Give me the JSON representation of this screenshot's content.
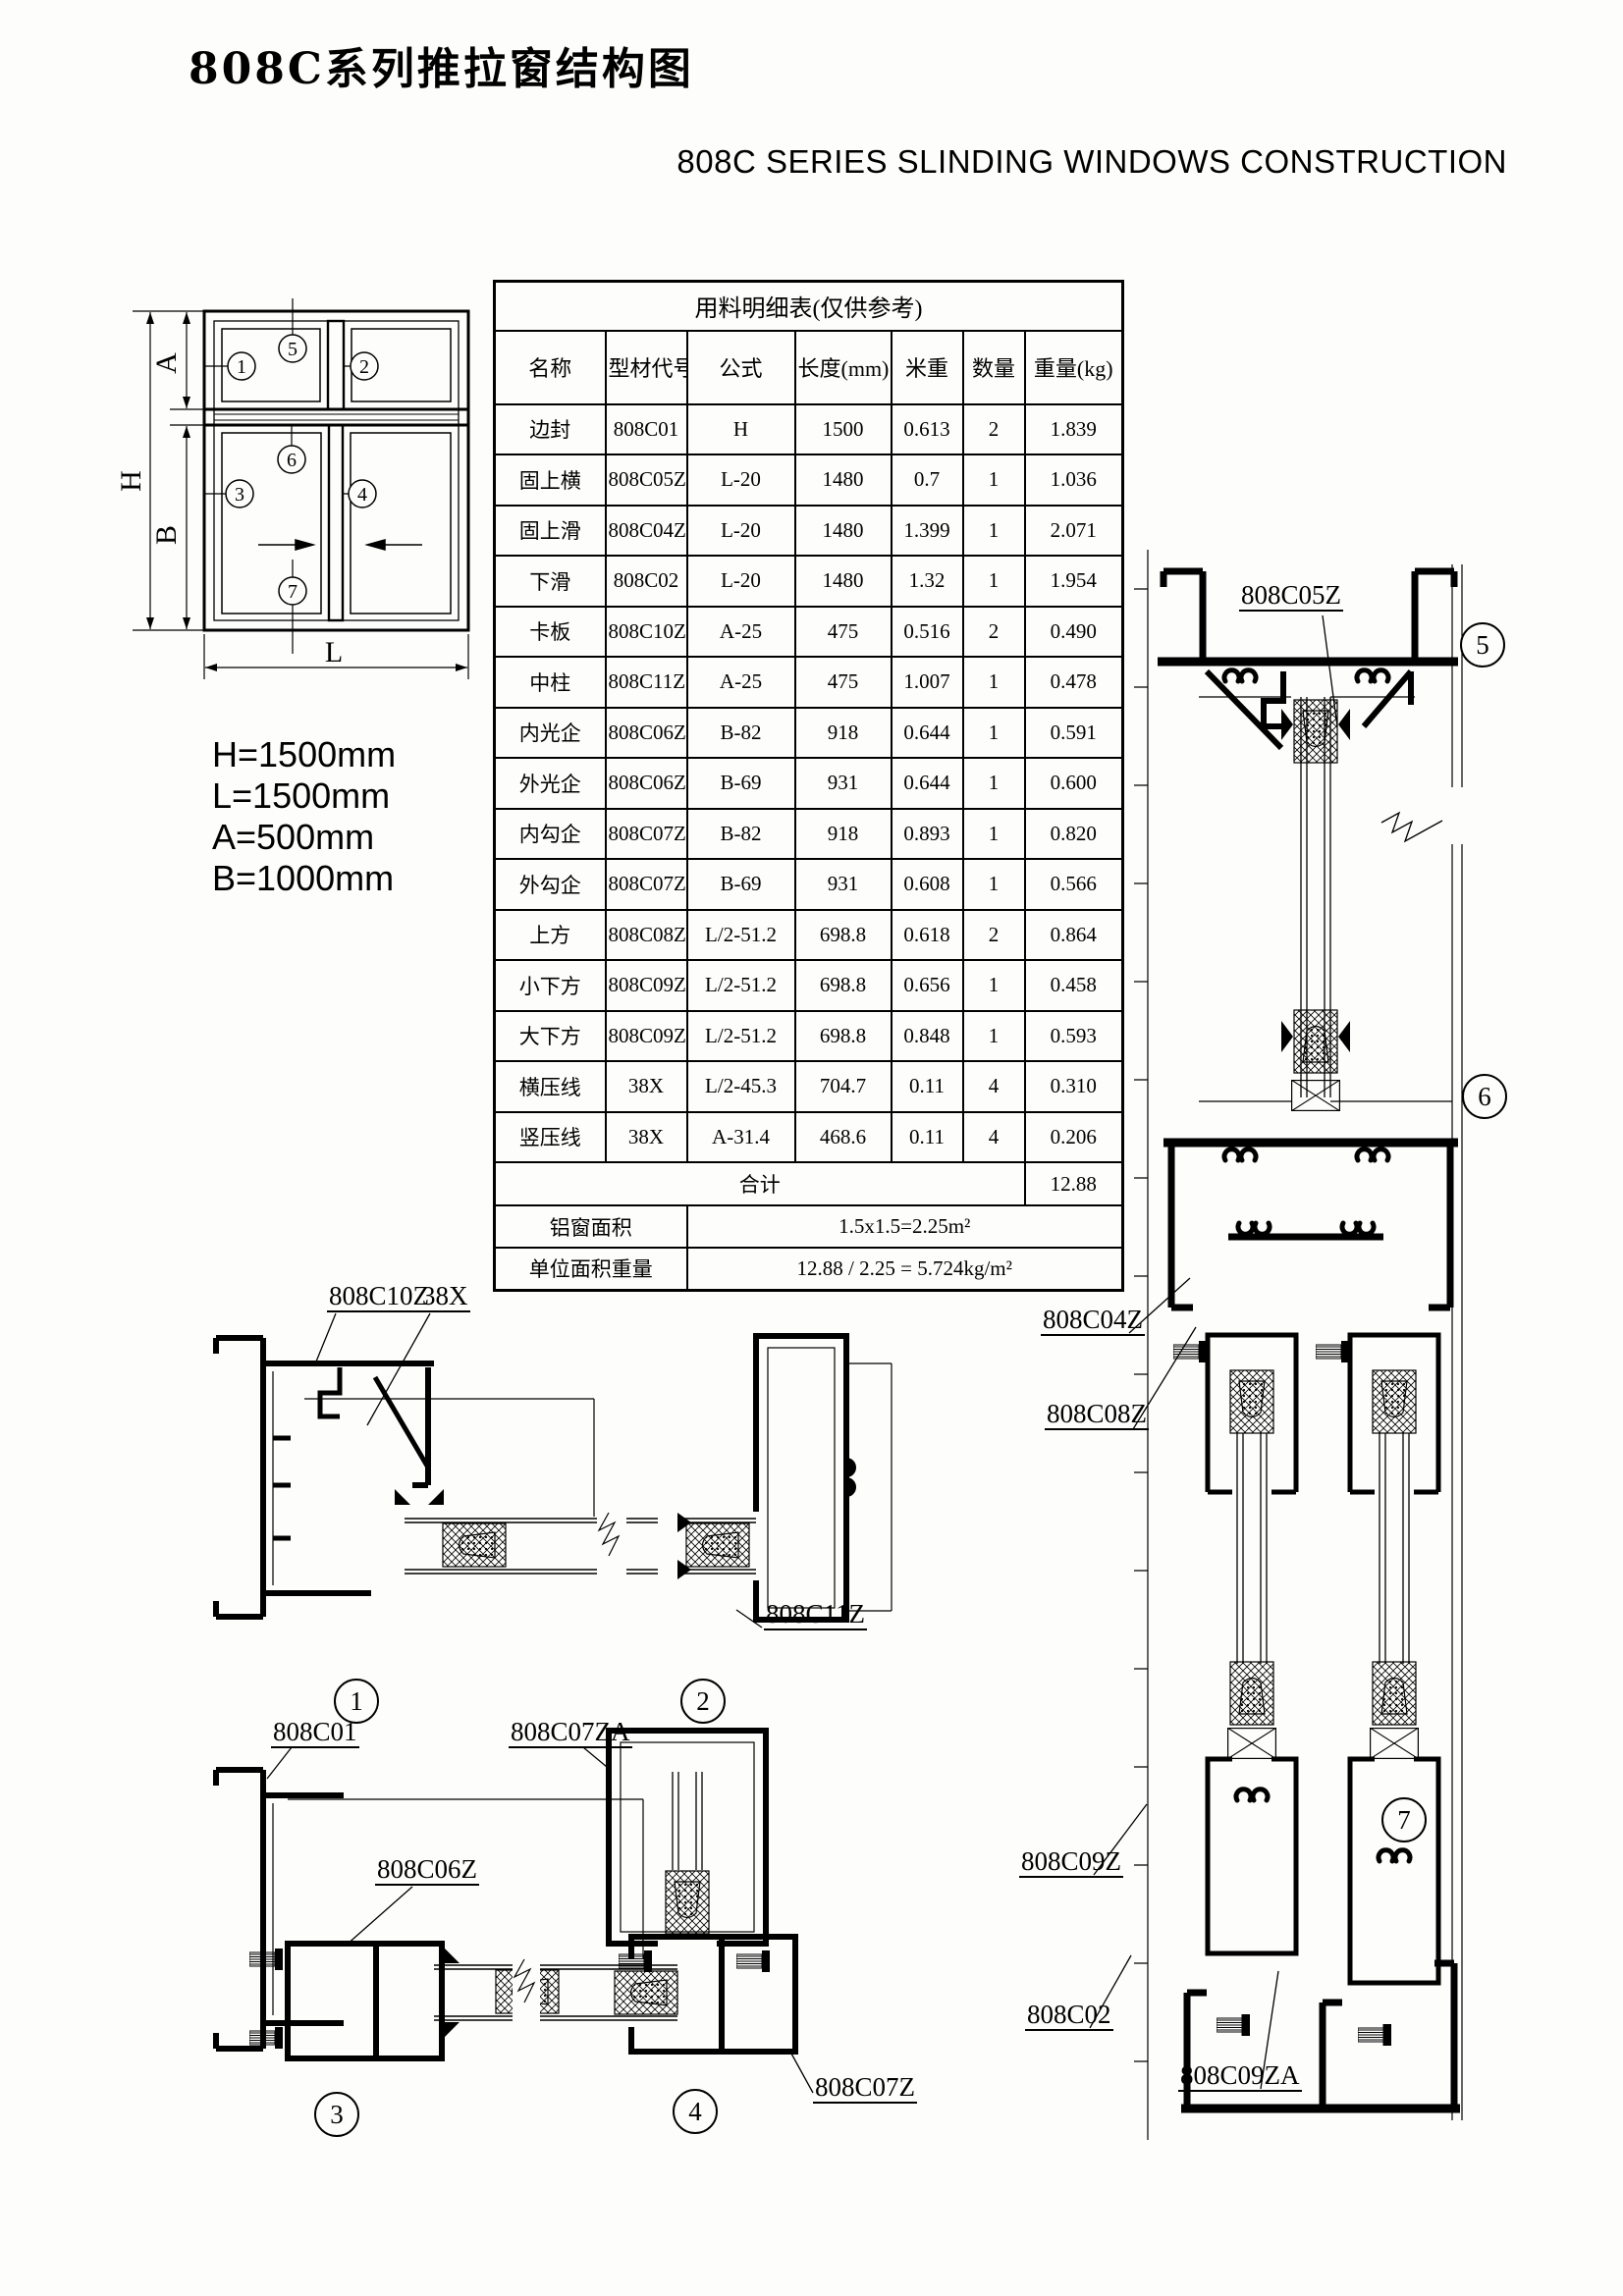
{
  "title": "808C系列推拉窗结构图",
  "subtitle": "808C  SERIES   SLINDING WINDOWS CONSTRUCTION",
  "schematic": {
    "dim_h": "H",
    "dim_a": "A",
    "dim_b": "B",
    "dim_l": "L"
  },
  "dimensions": {
    "h": "H=1500mm",
    "l": "L=1500mm",
    "a": "A=500mm",
    "b": "B=1000mm"
  },
  "callouts": {
    "n1": "1",
    "n2": "2",
    "n3": "3",
    "n4": "4",
    "n5": "5",
    "n6": "6",
    "n7": "7"
  },
  "part_labels": {
    "c05z": "808C05Z",
    "c04z": "808C04Z",
    "c08z": "808C08Z",
    "c09z": "808C09Z",
    "c02": "808C02",
    "c09za": "808C09ZA",
    "c10z": "808C10Z",
    "x38": "38X",
    "c11z": "808C11Z",
    "c01": "808C01",
    "c07za": "808C07ZA",
    "c06z": "808C06Z",
    "c07z": "808C07Z"
  },
  "table": {
    "title": "用料明细表(仅供参考)",
    "headers": [
      "名称",
      "型材代号",
      "公式",
      "长度(mm)",
      "米重",
      "数量",
      "重量(kg)"
    ],
    "rows": [
      [
        "边封",
        "808C01",
        "H",
        "1500",
        "0.613",
        "2",
        "1.839"
      ],
      [
        "固上横",
        "808C05Z",
        "L-20",
        "1480",
        "0.7",
        "1",
        "1.036"
      ],
      [
        "固上滑",
        "808C04Z",
        "L-20",
        "1480",
        "1.399",
        "1",
        "2.071"
      ],
      [
        "下滑",
        "808C02",
        "L-20",
        "1480",
        "1.32",
        "1",
        "1.954"
      ],
      [
        "卡板",
        "808C10Z",
        "A-25",
        "475",
        "0.516",
        "2",
        "0.490"
      ],
      [
        "中柱",
        "808C11Z",
        "A-25",
        "475",
        "1.007",
        "1",
        "0.478"
      ],
      [
        "内光企",
        "808C06Z",
        "B-82",
        "918",
        "0.644",
        "1",
        "0.591"
      ],
      [
        "外光企",
        "808C06Z",
        "B-69",
        "931",
        "0.644",
        "1",
        "0.600"
      ],
      [
        "内勾企",
        "808C07ZA",
        "B-82",
        "918",
        "0.893",
        "1",
        "0.820"
      ],
      [
        "外勾企",
        "808C07Z",
        "B-69",
        "931",
        "0.608",
        "1",
        "0.566"
      ],
      [
        "上方",
        "808C08Z",
        "L/2-51.2",
        "698.8",
        "0.618",
        "2",
        "0.864"
      ],
      [
        "小下方",
        "808C09Z",
        "L/2-51.2",
        "698.8",
        "0.656",
        "1",
        "0.458"
      ],
      [
        "大下方",
        "808C09ZA",
        "L/2-51.2",
        "698.8",
        "0.848",
        "1",
        "0.593"
      ],
      [
        "横压线",
        "38X",
        "L/2-45.3",
        "704.7",
        "0.11",
        "4",
        "0.310"
      ],
      [
        "竖压线",
        "38X",
        "A-31.4",
        "468.6",
        "0.11",
        "4",
        "0.206"
      ]
    ],
    "total_label": "合计",
    "total_value": "12.88",
    "area_label": "铝窗面积",
    "area_value": "1.5x1.5=2.25m²",
    "unit_label": "单位面积重量",
    "unit_value": "12.88 / 2.25 = 5.724kg/m²"
  }
}
